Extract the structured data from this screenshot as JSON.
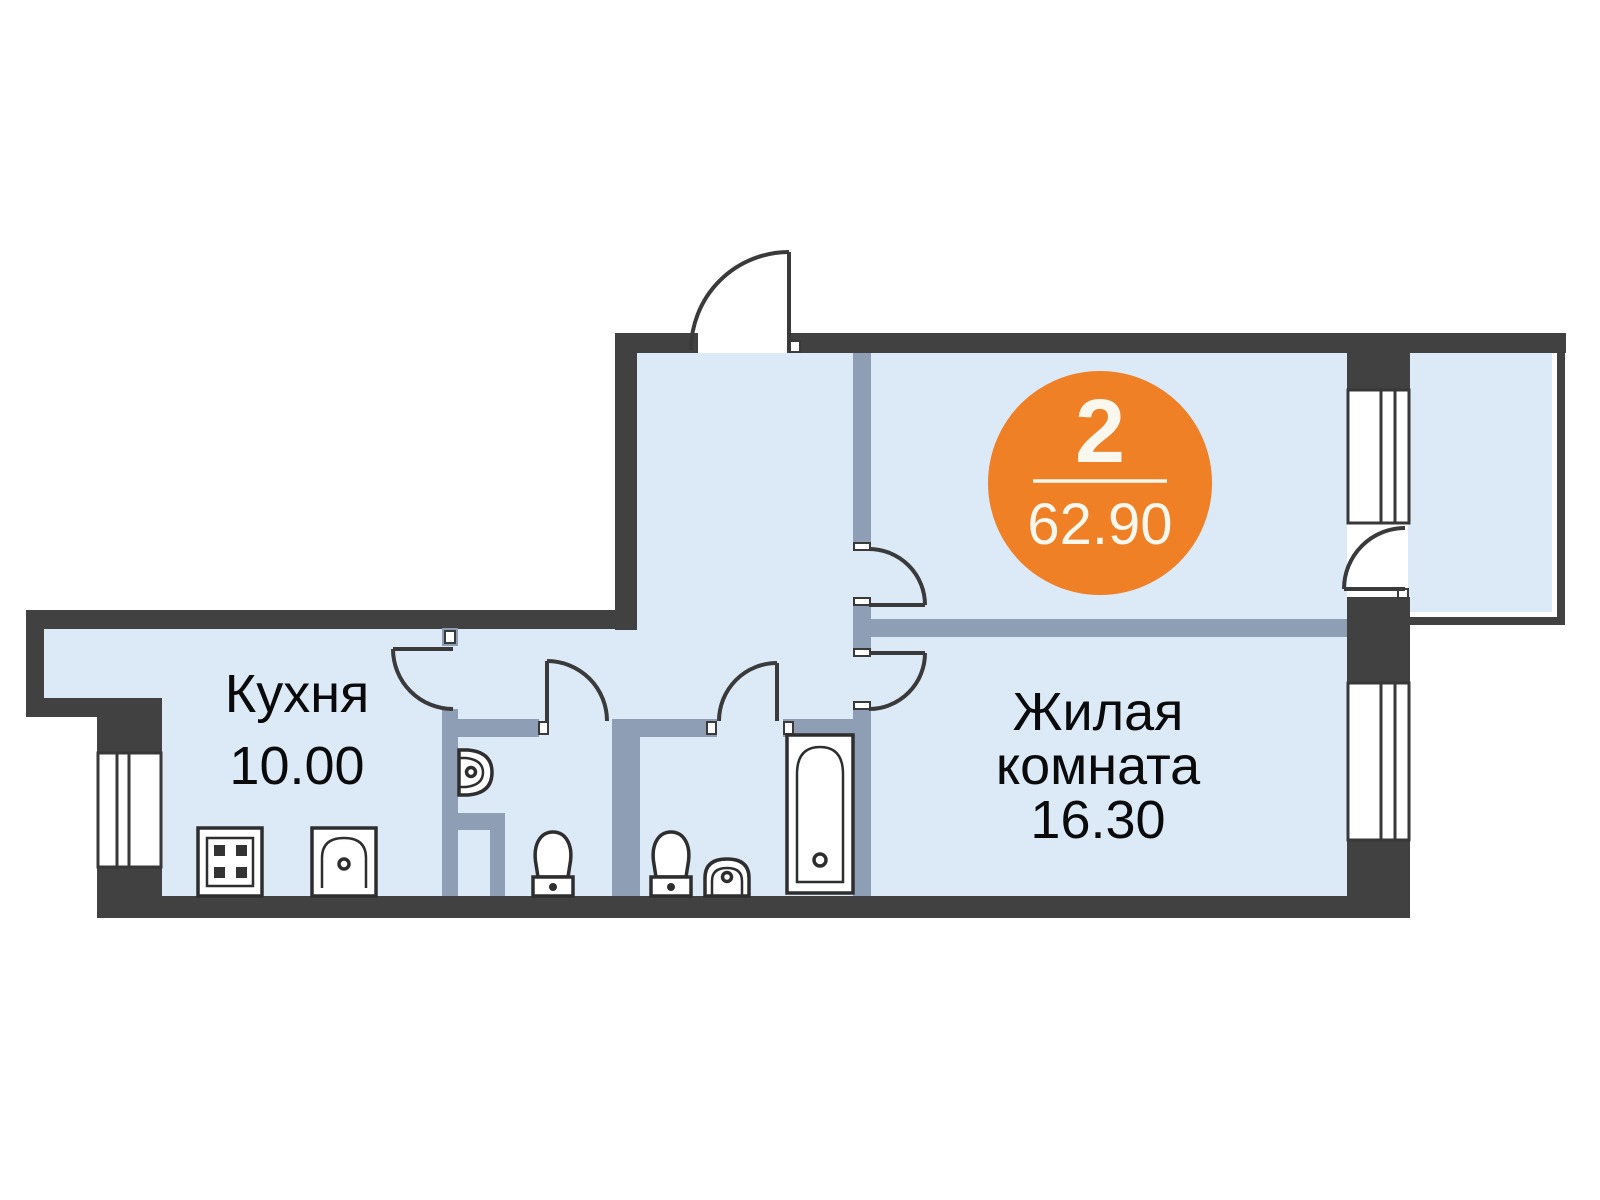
{
  "badge": {
    "rooms_count": "2",
    "total_area": "62.90"
  },
  "rooms": {
    "kitchen": {
      "name": "Кухня",
      "area": "10.00"
    },
    "living": {
      "name_line1": "Жилая",
      "name_line2": "комната",
      "area": "16.30"
    }
  },
  "fixtures": {
    "stove": "stove-icon",
    "kitchen_sink": "kitchen-sink-icon",
    "wall_sink": "wall-sink-icon",
    "toilet": "toilet-icon",
    "bath_sink": "bath-sink-icon",
    "bathtub": "bathtub-icon",
    "window": "window-icon",
    "door": "door-swing-icon"
  },
  "colors": {
    "exterior_wall": "#414141",
    "partition_wall": "#8D9EB5",
    "floor_fill": "#DCEAF8",
    "badge_orange": "#EF8026",
    "badge_text": "#F9F7EE",
    "label_text": "#0A0A0A"
  }
}
